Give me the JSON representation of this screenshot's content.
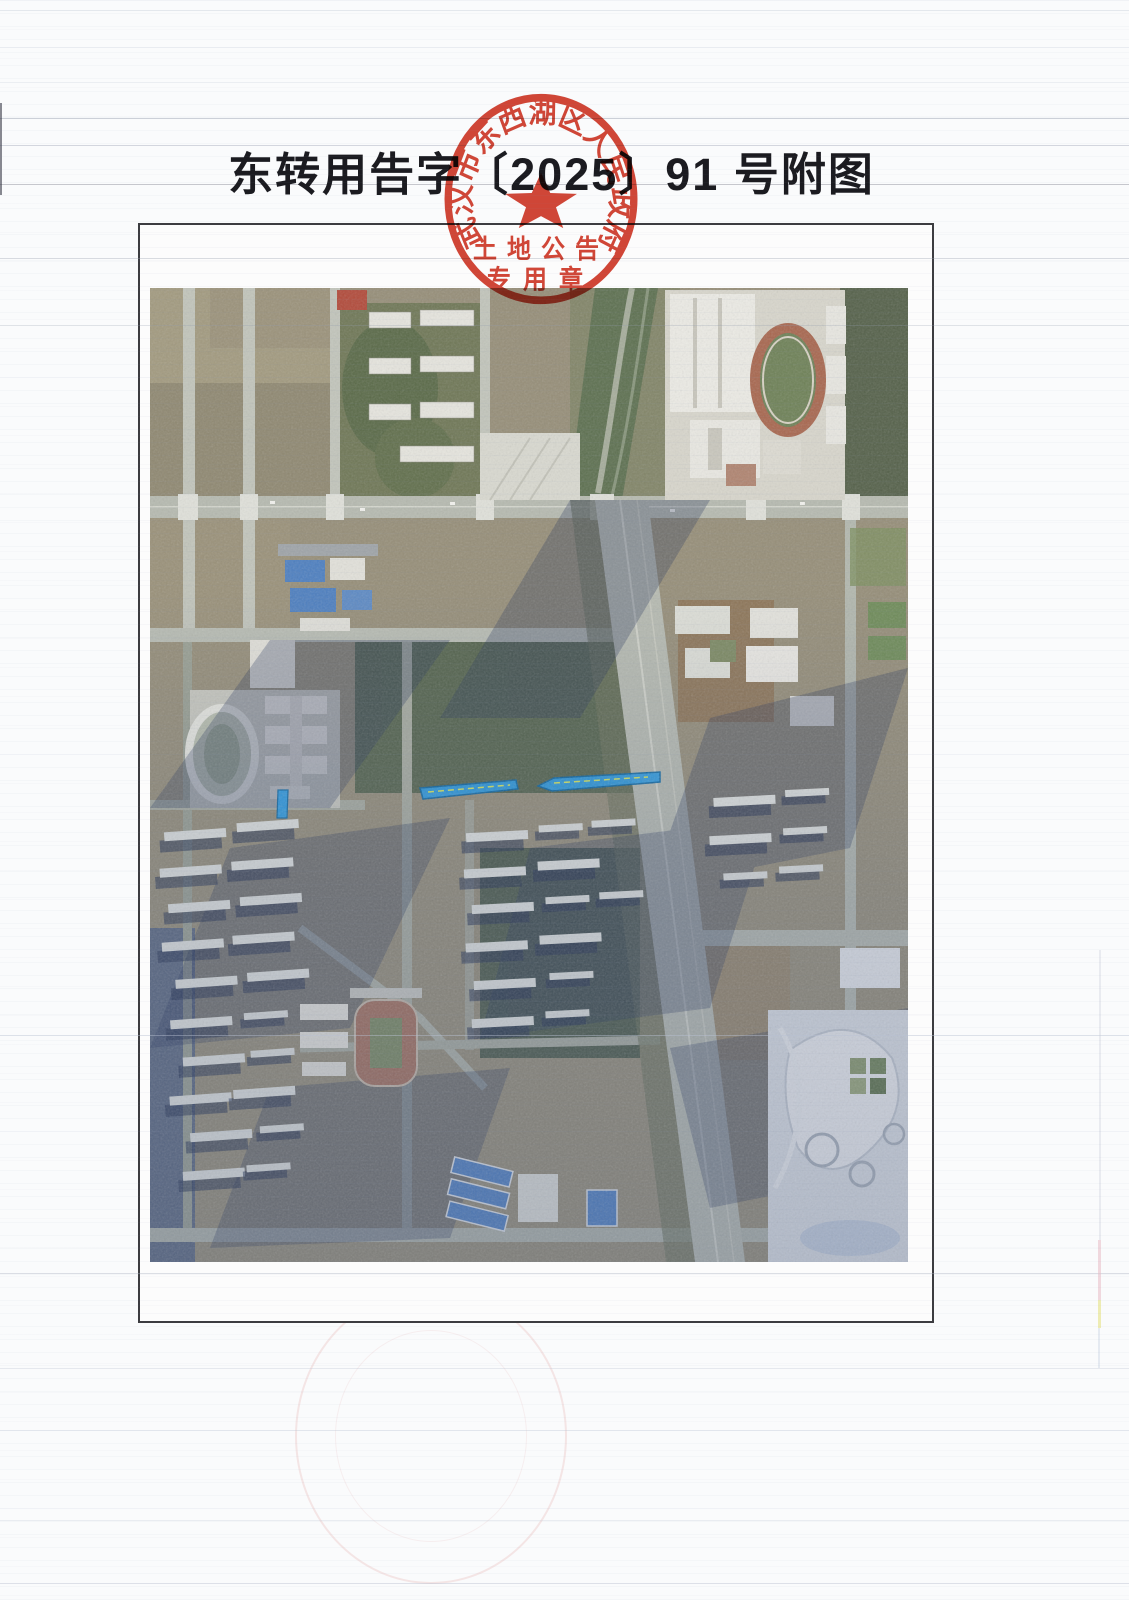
{
  "page": {
    "title": "东转用告字〔2025〕91 号附图"
  },
  "seal": {
    "ring_text": "武汉市东西湖区人民政府",
    "row1": "土地公告",
    "row2": "专用章",
    "color": "#cf3726"
  },
  "map": {
    "highlight_color": "#2f93d6"
  }
}
